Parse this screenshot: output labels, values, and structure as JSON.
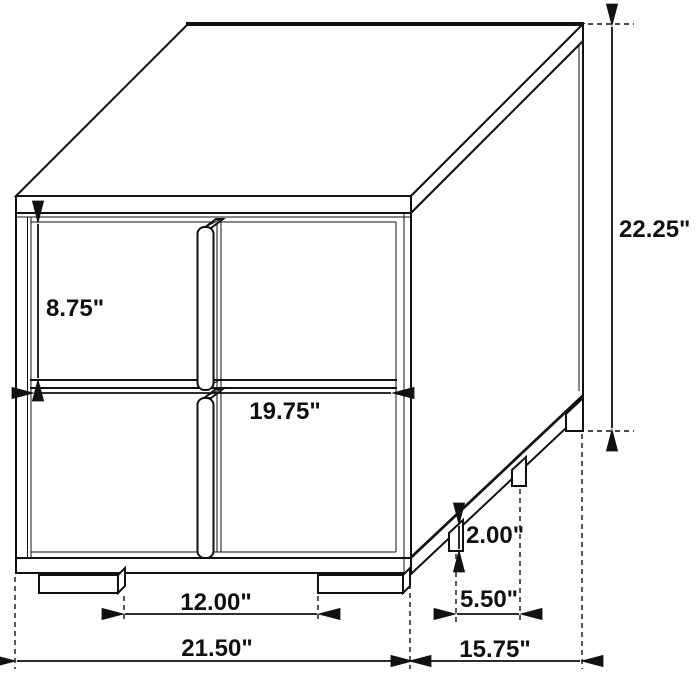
{
  "diagram": {
    "type": "furniture-dimension-drawing",
    "subject": "two-drawer nightstand, isometric line drawing with dimension callouts",
    "unit": "inches",
    "background_color": "#ffffff",
    "line_color": "#111111",
    "dimensions": {
      "drawer_front_height": {
        "label": "8.75\"",
        "meaning": "height of one drawer front"
      },
      "drawer_front_width": {
        "label": "19.75\"",
        "meaning": "width of drawer front"
      },
      "overall_height": {
        "label": "22.25\"",
        "meaning": "overall height"
      },
      "leg_height": {
        "label": "2.00\"",
        "meaning": "leg height"
      },
      "side_leg_spacing": {
        "label": "5.50\"",
        "meaning": "spacing between side legs"
      },
      "front_leg_spacing": {
        "label": "12.00\"",
        "meaning": "spacing between front legs"
      },
      "overall_width": {
        "label": "21.50\"",
        "meaning": "overall width"
      },
      "overall_depth": {
        "label": "15.75\"",
        "meaning": "overall depth"
      }
    }
  }
}
